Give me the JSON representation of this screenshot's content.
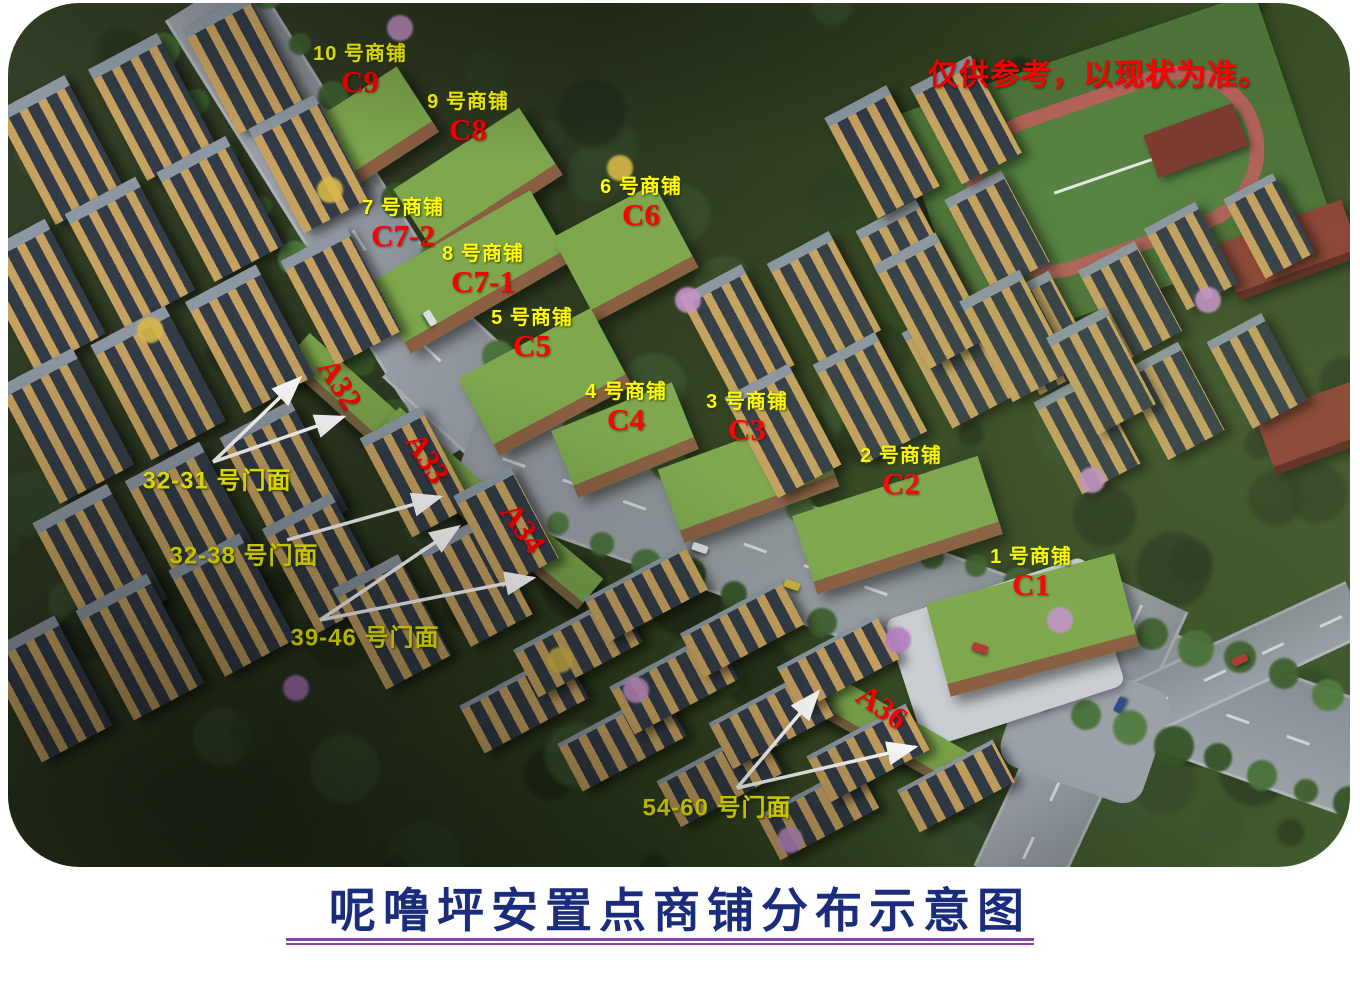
{
  "title": {
    "text": "呢噜坪安置点商铺分布示意图"
  },
  "disclaimer": {
    "text": "仅供参考，以现状为准。"
  },
  "shops": [
    {
      "name": "10 号商铺",
      "code": "C9"
    },
    {
      "name": "9 号商铺",
      "code": "C8"
    },
    {
      "name": "7 号商铺",
      "code": "C7-2"
    },
    {
      "name": "6 号商铺",
      "code": "C6"
    },
    {
      "name": "8 号商铺",
      "code": "C7-1"
    },
    {
      "name": "5 号商铺",
      "code": "C5"
    },
    {
      "name": "4 号商铺",
      "code": "C4"
    },
    {
      "name": "3 号商铺",
      "code": "C3"
    },
    {
      "name": "2 号商铺",
      "code": "C2"
    },
    {
      "name": "1 号商铺",
      "code": "C1"
    }
  ],
  "building_codes": [
    {
      "code": "A32"
    },
    {
      "code": "A33"
    },
    {
      "code": "A34"
    },
    {
      "code": "A36"
    }
  ],
  "storefronts": [
    {
      "label": "32-31 号门面"
    },
    {
      "label": "32-38 号门面"
    },
    {
      "label": "39-46 号门面"
    },
    {
      "label": "54-60 号门面"
    }
  ],
  "colors": {
    "shop_name_text": "#ffff00",
    "shop_code_text": "#ff0000",
    "building_code_text": "#ff0000",
    "storefront_text": "#ffff00",
    "arrow": "#ffffff",
    "disclaimer_text": "#ff0000",
    "title_text": "#1b2c7c",
    "title_underline": "#8a42a8"
  }
}
